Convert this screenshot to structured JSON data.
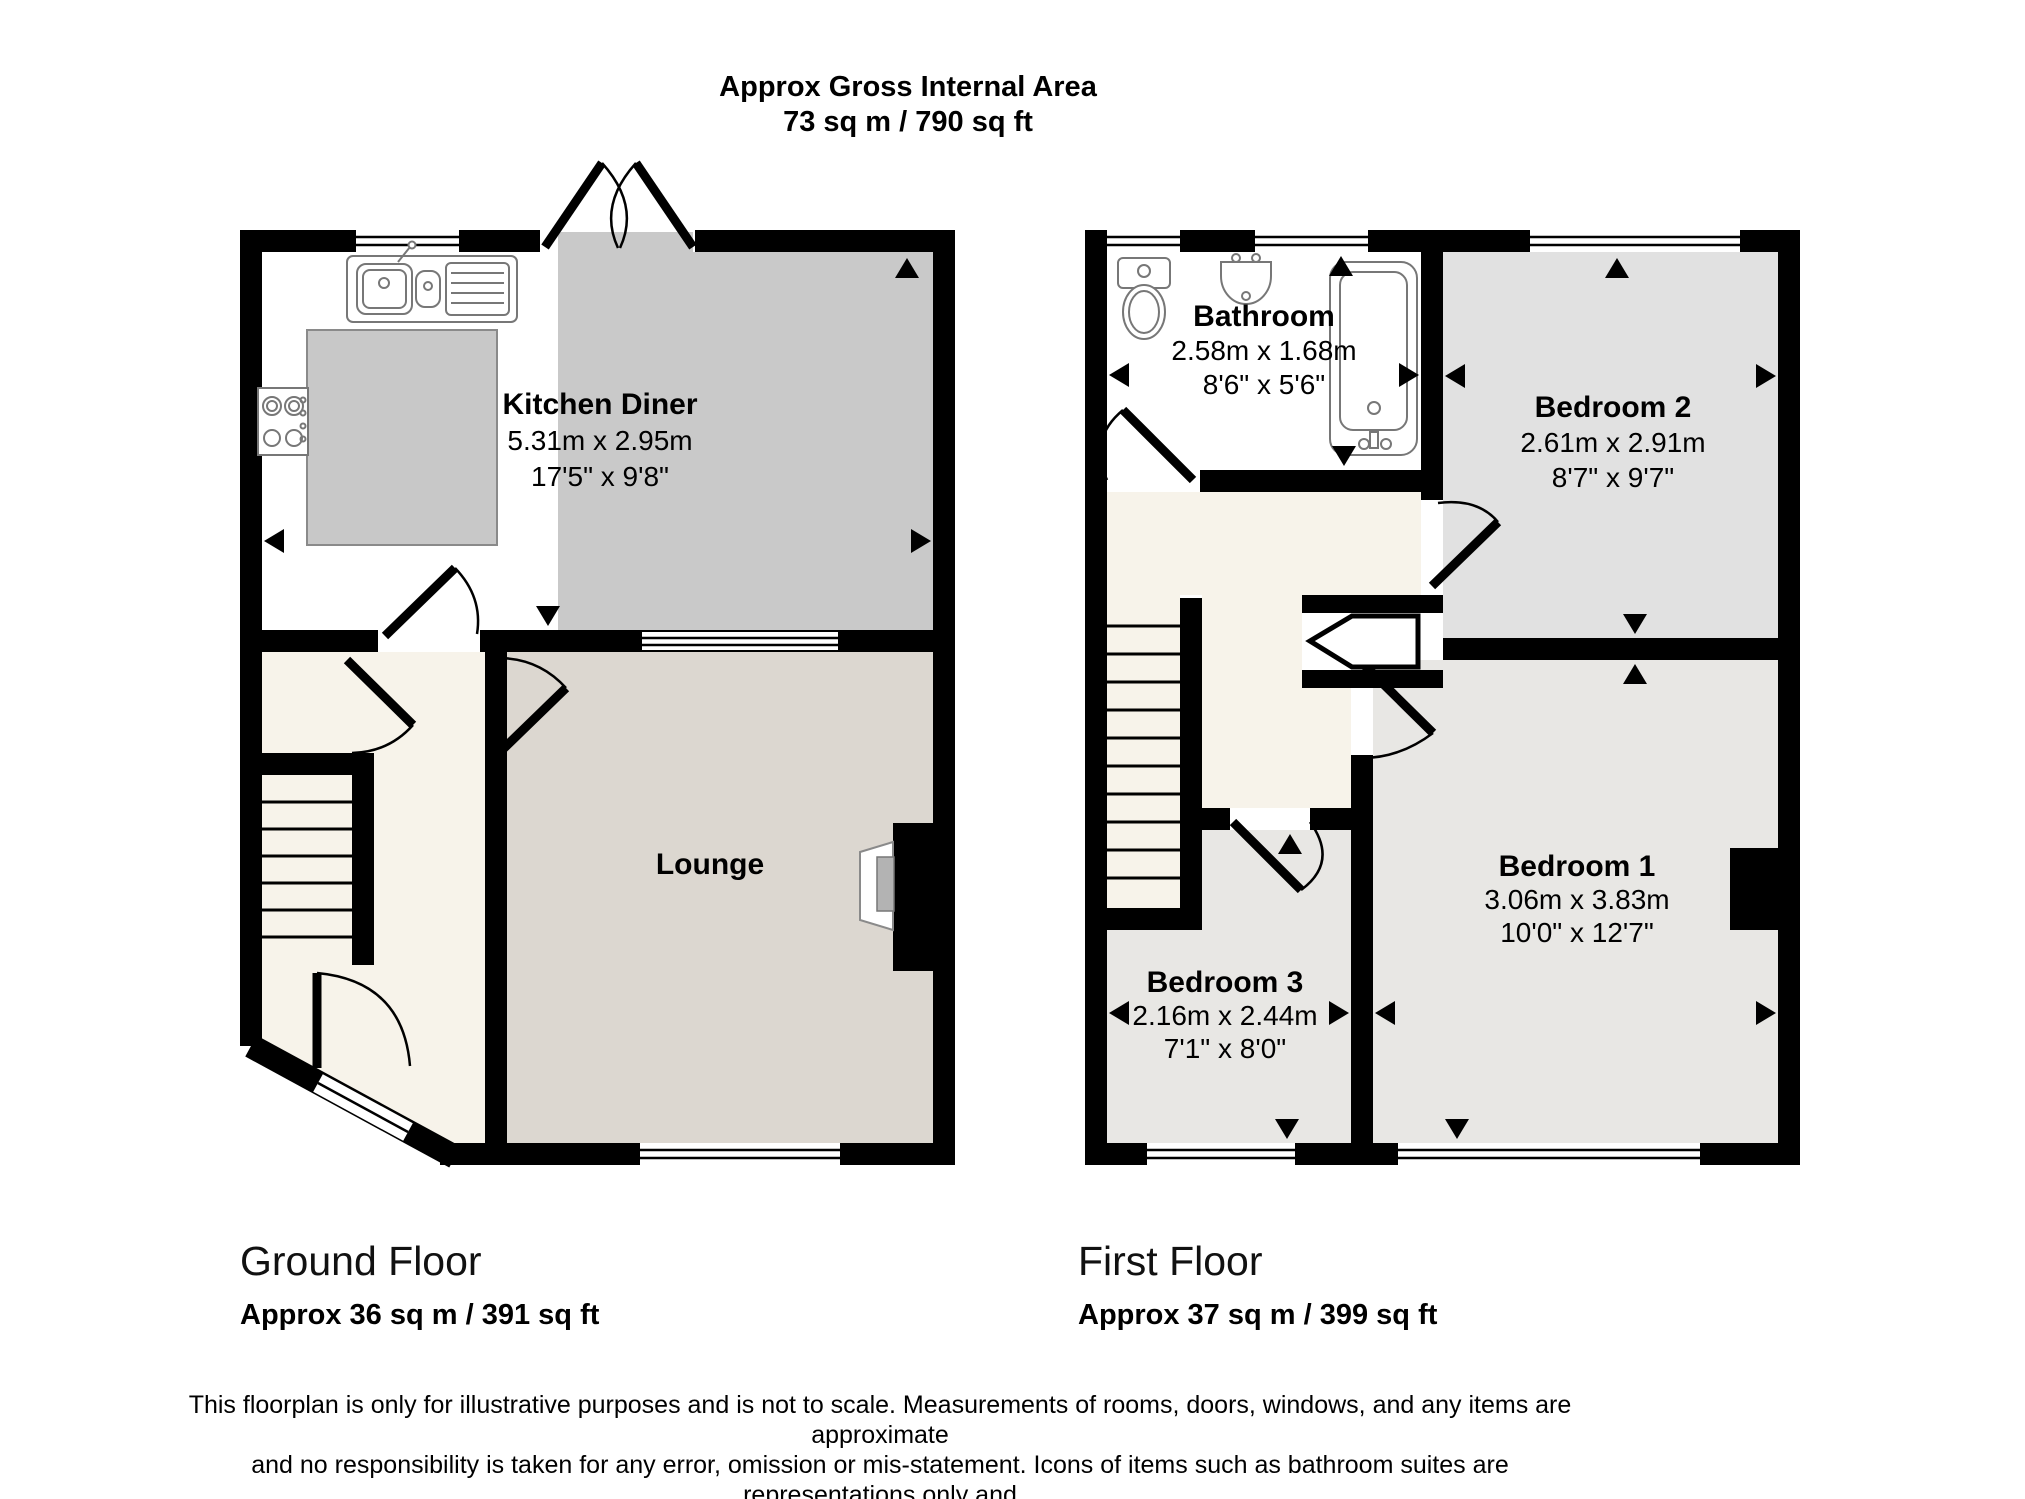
{
  "title": {
    "line1": "Approx Gross Internal Area",
    "line2": "73 sq m / 790 sq ft"
  },
  "ground": {
    "label": "Ground Floor",
    "area": "Approx 36 sq m / 391 sq ft",
    "rooms": {
      "kitchen_diner": {
        "name": "Kitchen Diner",
        "metric": "5.31m x 2.95m",
        "imperial": "17'5\" x 9'8\""
      },
      "lounge": {
        "name": "Lounge"
      }
    }
  },
  "first": {
    "label": "First Floor",
    "area": "Approx 37 sq m / 399 sq ft",
    "rooms": {
      "bathroom": {
        "name": "Bathroom",
        "metric": "2.58m x 1.68m",
        "imperial": "8'6\" x 5'6\""
      },
      "bedroom2": {
        "name": "Bedroom 2",
        "metric": "2.61m x 2.91m",
        "imperial": "8'7\" x 9'7\""
      },
      "bedroom1": {
        "name": "Bedroom 1",
        "metric": "3.06m x 3.83m",
        "imperial": "10'0\" x 12'7\""
      },
      "bedroom3": {
        "name": "Bedroom 3",
        "metric": "2.16m x 2.44m",
        "imperial": "7'1\" x 8'0\""
      }
    }
  },
  "disclaimer": {
    "line1": "This floorplan is only for illustrative purposes and is not to scale. Measurements of rooms, doors, windows, and any items are approximate",
    "line2": "and no responsibility is taken for any error, omission or mis-statement. Icons of items such as bathroom suites are representations only and",
    "line3": "may not look like the real items. Made with Made Snappy 360."
  },
  "colors": {
    "wall": "#000000",
    "kitchen_floor": "#c9c9c9",
    "counter": "#c8c8c8",
    "lounge_floor": "#dcd7d0",
    "hall_floor": "#f7f3ea",
    "bedroom2_floor": "#e1e1e1",
    "bedroom_floor": "#e8e7e4",
    "bathroom_floor": "#ffffff",
    "tv": "#b3b3b3"
  }
}
